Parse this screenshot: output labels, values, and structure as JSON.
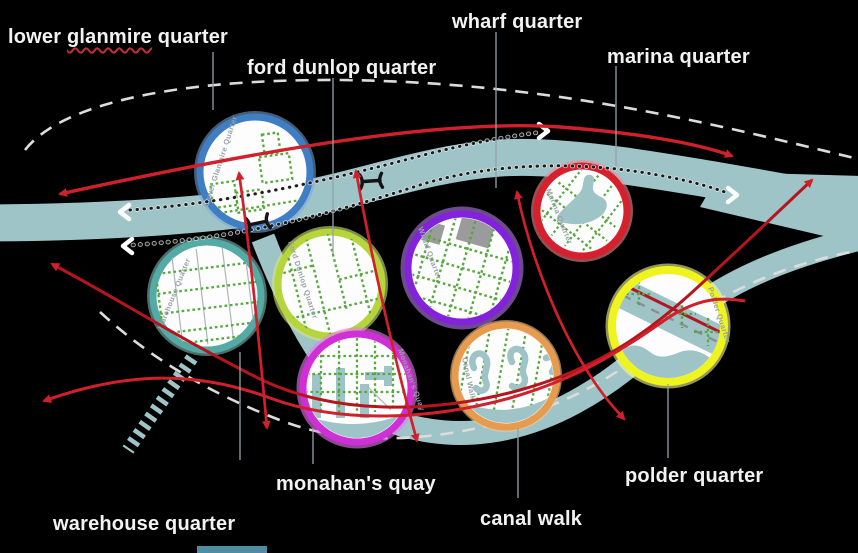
{
  "diagram": {
    "title": "docklands quarters diagram",
    "background_color": "#000000",
    "labels": {
      "lower_glanmire": {
        "pre": "lower ",
        "marked": "glanmire",
        "post": " quarter"
      },
      "ford_dunlop": "ford dunlop quarter",
      "wharf": "wharf quarter",
      "marina": "marina quarter",
      "monahans": "monahan's quay",
      "warehouse": "warehouse quarter",
      "canal": "canal walk",
      "polder": "polder quarter"
    },
    "quarters": [
      {
        "id": "lower-glanmire",
        "label": "lower glanmire quarter",
        "inner_label": "Lower Glanmire Quarter",
        "ring_color": "#3f7ec4"
      },
      {
        "id": "warehouse",
        "label": "warehouse quarter",
        "inner_label": "Warehouse Quarter",
        "ring_color": "#54aaa4"
      },
      {
        "id": "ford-dunlop",
        "label": "ford dunlop quarter",
        "inner_label": "Ford Dunlop Quarter",
        "ring_color": "#b6d43b"
      },
      {
        "id": "wharf",
        "label": "wharf quarter",
        "inner_label": "Wharf Quarter",
        "ring_color": "#8322dd"
      },
      {
        "id": "marina",
        "label": "marina quarter",
        "inner_label": "Marina Quarter",
        "ring_color": "#d6202d"
      },
      {
        "id": "monahans-quay",
        "label": "monahan's quay",
        "inner_label": "Monahan's Quay",
        "ring_color": "#d02ed6"
      },
      {
        "id": "canal-walk",
        "label": "canal walk",
        "inner_label": "Canal Walk",
        "ring_color": "#e69b4e"
      },
      {
        "id": "polder",
        "label": "polder quarter",
        "inner_label": "Polder Quarter",
        "ring_color": "#f0f41e"
      }
    ],
    "colors": {
      "river": "#9fc4c8",
      "route_red": "#cf202b",
      "route_dark_red": "#a8161f",
      "boundary_dash_white": "#e0e0e0",
      "bank_dots_black": "#1c1c1c",
      "grid_green": "#55a83b",
      "building_gray": "#9b9b9b",
      "connector_gray": "#94a2a6",
      "circle_fill_white": "#fdfdfd"
    }
  }
}
